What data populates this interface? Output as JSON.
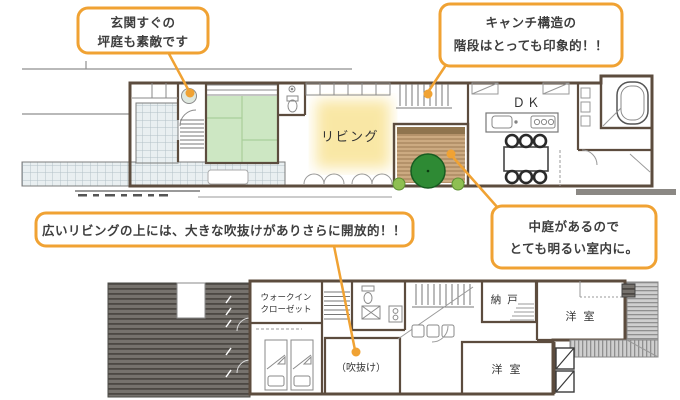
{
  "colors": {
    "accent_orange": "#f0a233",
    "living_glow": "#f9e7a5",
    "tatami_green": "#cde7c3",
    "tree_green": "#2e8a34"
  },
  "callouts": {
    "entrance": {
      "line1": "玄関すぐの",
      "line2": "坪庭も素敵です"
    },
    "stairs": {
      "line1": "キャンチ構造の",
      "line2": "階段はとっても印象的！！"
    },
    "openness": {
      "line1": "広いリビングの上には、大きな吹抜けがありさらに開放的！！"
    },
    "courtyard": {
      "line1": "中庭があるので",
      "line2": "とても明るい室内に。"
    }
  },
  "floor1": {
    "living_label": "リビング",
    "dk_label": "ＤＫ"
  },
  "floor2": {
    "wic_label_line1": "ウォークイン",
    "wic_label_line2": "クローゼット",
    "nando_label": "納 戸",
    "western_room_top_label": "洋 室",
    "western_room_bottom_label": "洋 室",
    "void_label": "（吹抜け）"
  }
}
